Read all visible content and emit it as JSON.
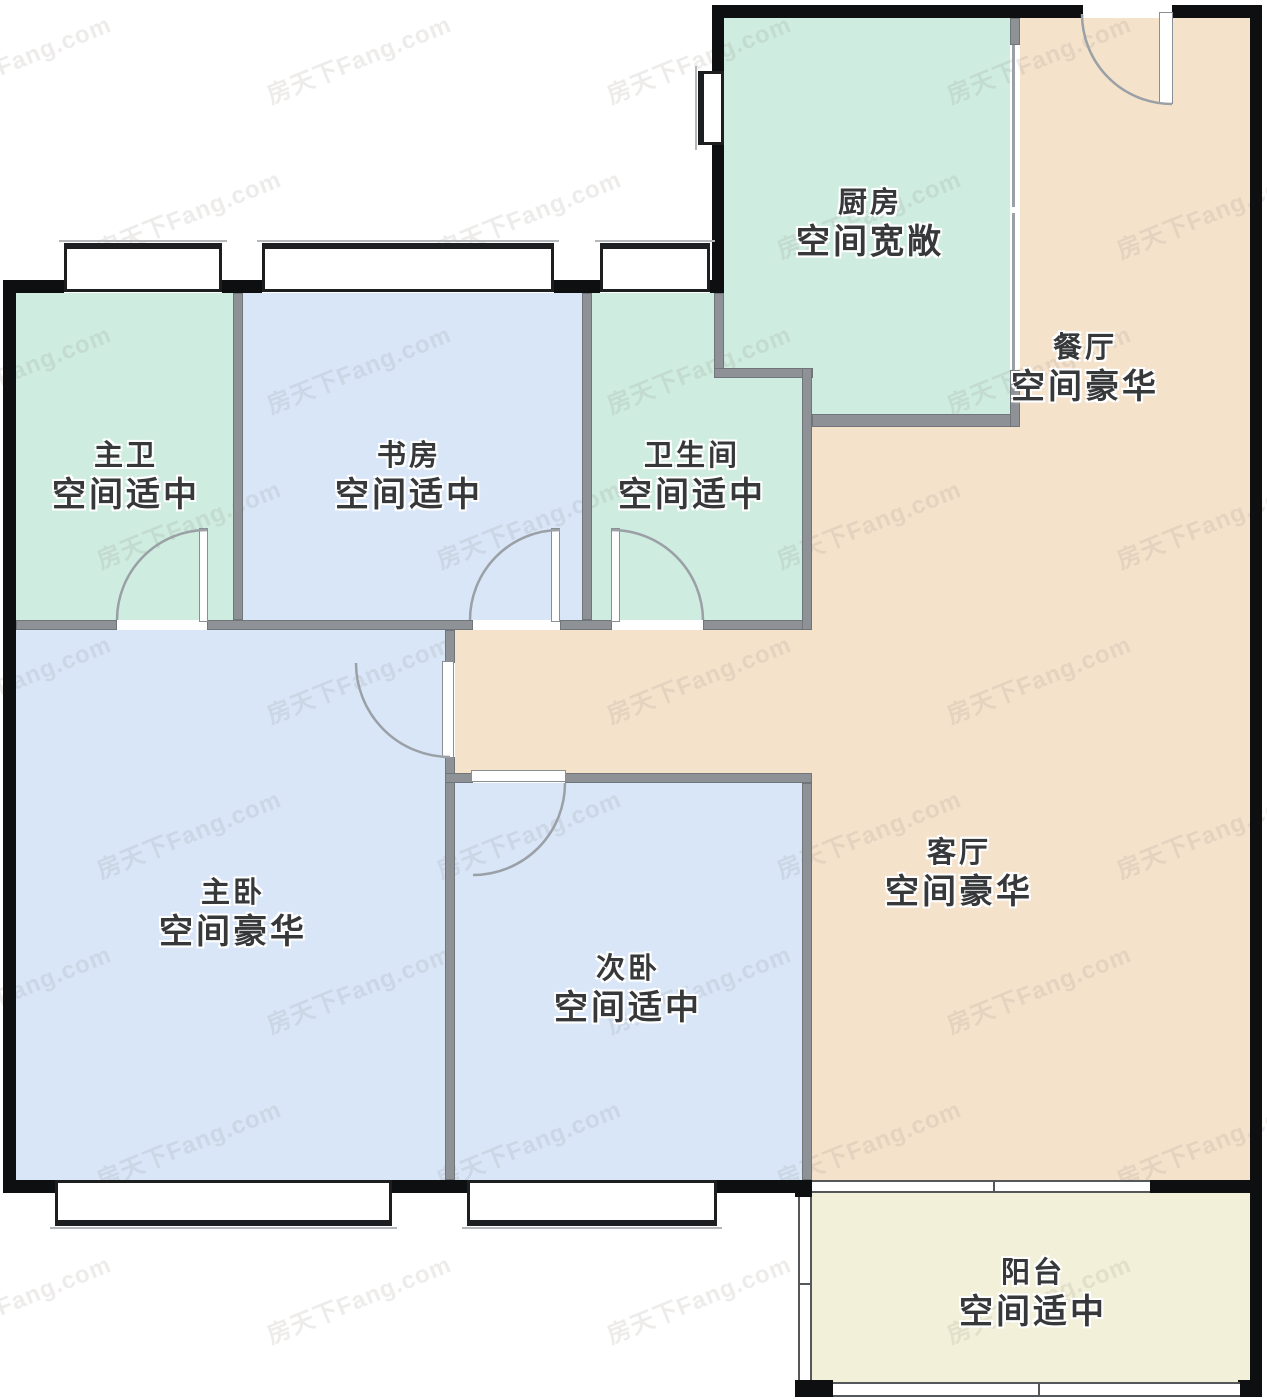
{
  "watermark": "房天下Fang.com",
  "rooms": {
    "kitchen": {
      "name": "厨房",
      "desc": "空间宽敞"
    },
    "dining": {
      "name": "餐厅",
      "desc": "空间豪华"
    },
    "master_bath": {
      "name": "主卫",
      "desc": "空间适中"
    },
    "study": {
      "name": "书房",
      "desc": "空间适中"
    },
    "bathroom": {
      "name": "卫生间",
      "desc": "空间适中"
    },
    "master_bedroom": {
      "name": "主卧",
      "desc": "空间豪华"
    },
    "second_bedroom": {
      "name": "次卧",
      "desc": "空间适中"
    },
    "living": {
      "name": "客厅",
      "desc": "空间豪华"
    },
    "balcony": {
      "name": "阳台",
      "desc": "空间适中"
    }
  },
  "colors": {
    "mint": "#ceecdf",
    "blue": "#d8e6f8",
    "peach": "#f5e2cb",
    "balcony_yellow": "#f2f0d8",
    "wall_black": "#0d0f11",
    "wall_gray": "#8e9296"
  }
}
